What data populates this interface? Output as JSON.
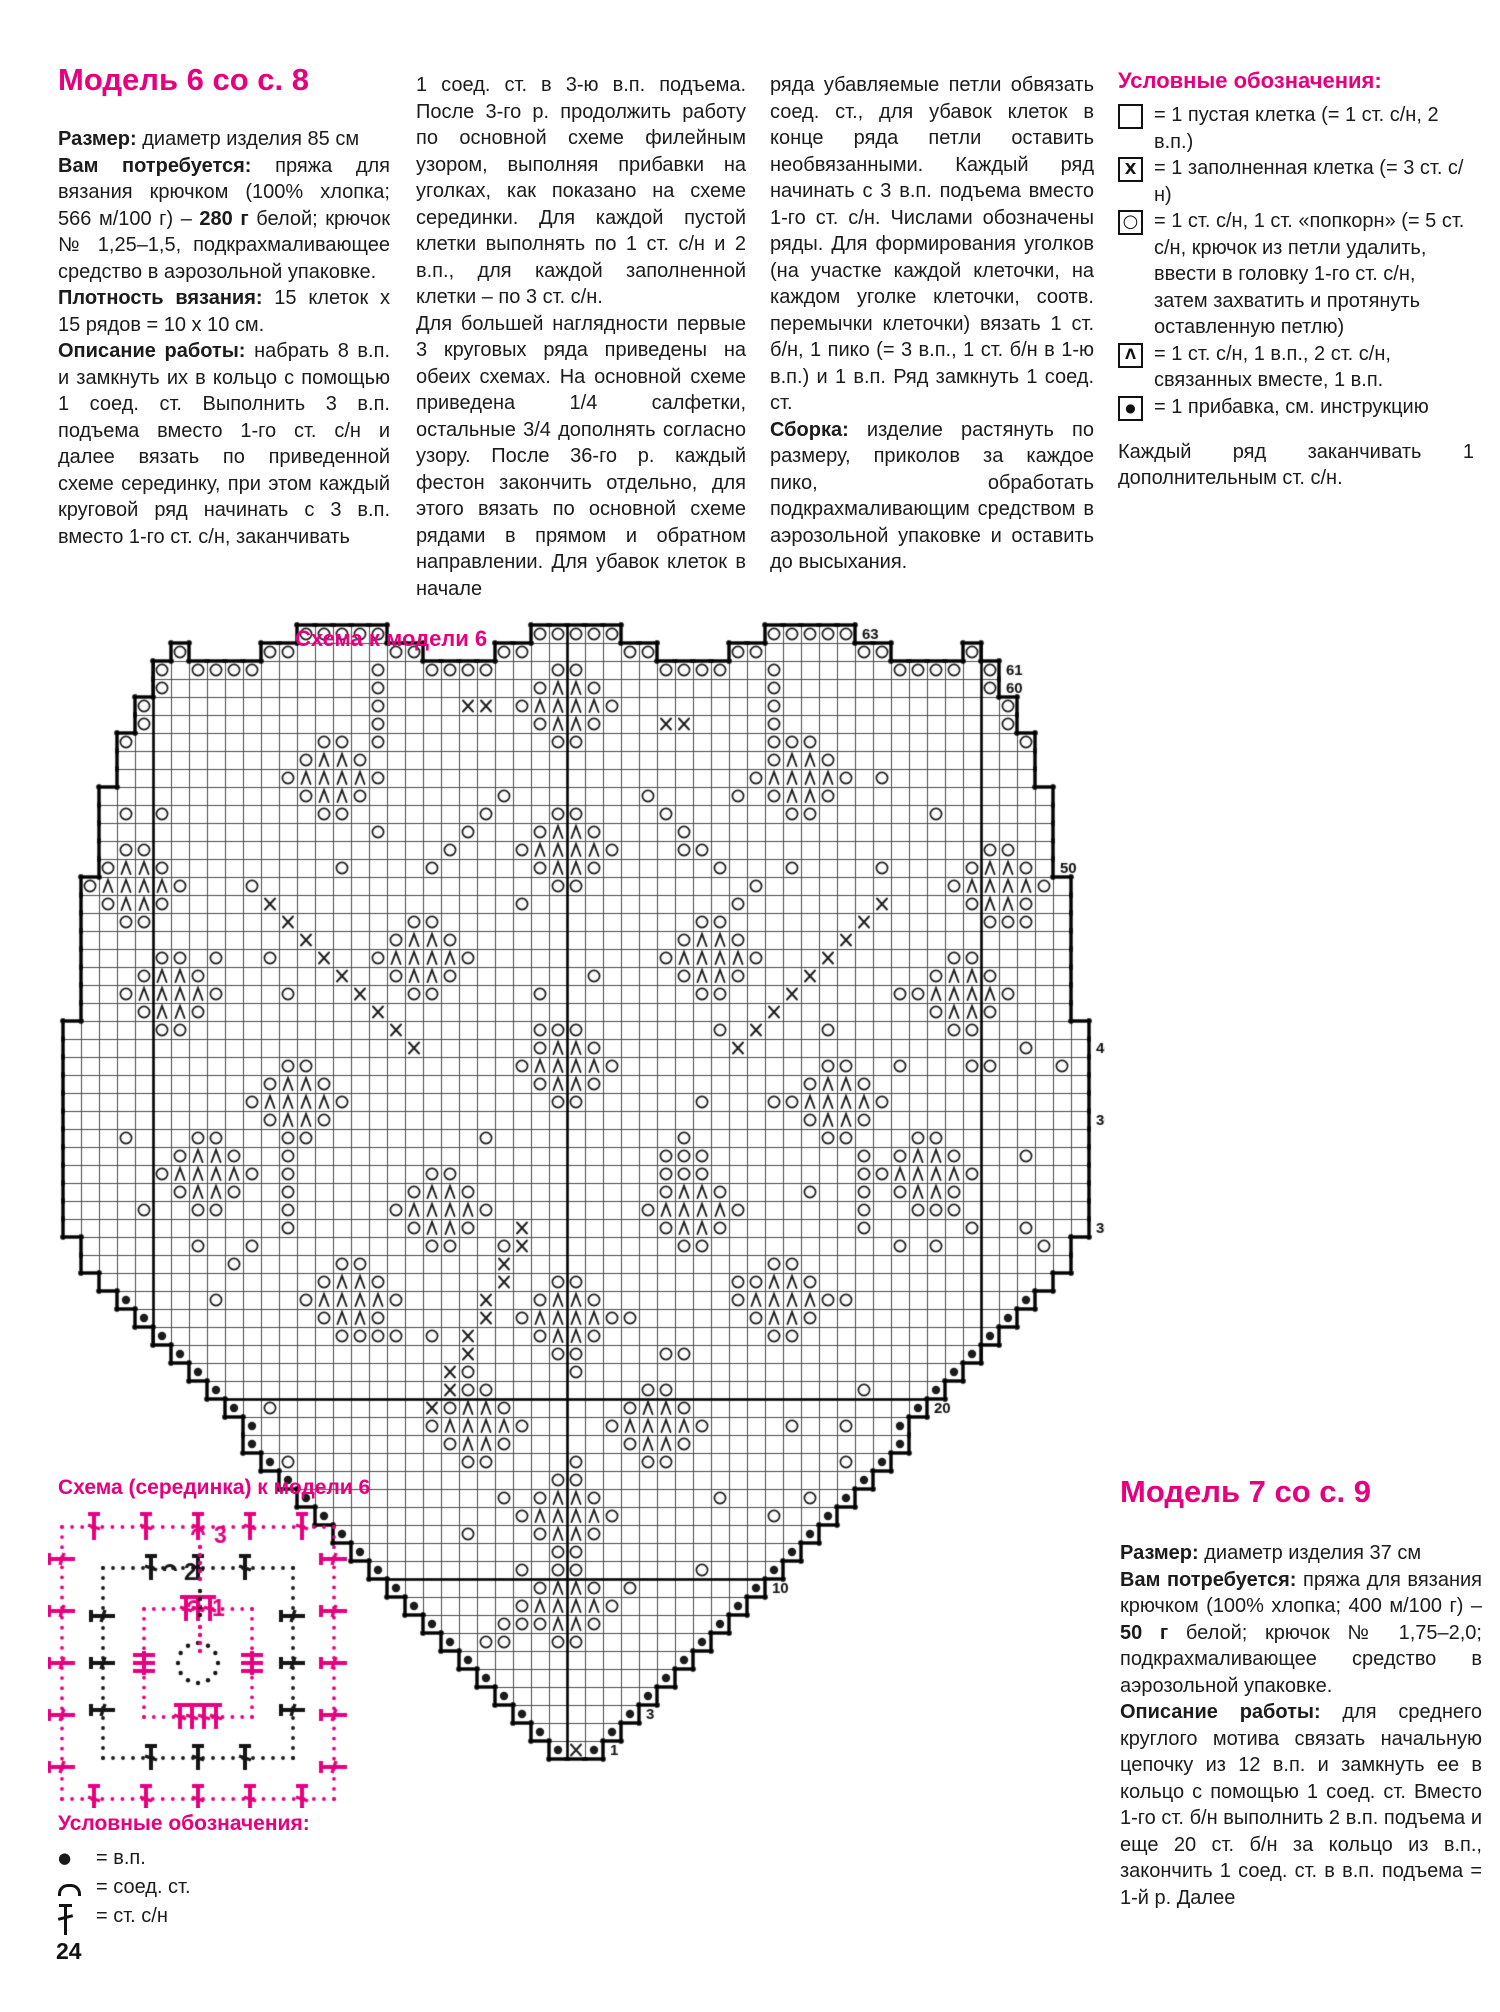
{
  "colors": {
    "accent": "#e6007e",
    "ink": "#1b1b1b",
    "grid": "#4a4a4a"
  },
  "page": {
    "number": "24"
  },
  "model6": {
    "title": "Модель 6 со с. 8",
    "col1": [
      [
        {
          "t": "Размер:",
          "b": true
        },
        {
          "t": " диаметр изделия 85 см"
        }
      ],
      [
        {
          "t": "Вам потребуется:",
          "b": true
        },
        {
          "t": " пряжа для вязания крючком (100% хлопка; 566 м/100 г) – "
        },
        {
          "t": "280 г",
          "b": true
        },
        {
          "t": " белой; крючок № 1,25–1,5, подкрахмаливающее средство в аэрозольной упаковке."
        }
      ],
      [
        {
          "t": "Плотность вязания:",
          "b": true
        },
        {
          "t": " 15 клеток x 15 рядов = 10 x 10 см."
        }
      ],
      [
        {
          "t": "Описание работы:",
          "b": true
        },
        {
          "t": " набрать 8 в.п. и замкнуть их в кольцо с помощью 1 соед. ст. Выполнить 3 в.п. подъема вместо 1-го ст. с/н и далее вязать по приведенной схеме серединку, при этом каждый круговой ряд начинать с 3 в.п. вместо 1-го ст. с/н, заканчивать"
        }
      ]
    ],
    "col2": [
      [
        {
          "t": "1 соед. ст. в 3-ю в.п. подъема. После 3-го р. продолжить работу по основной схеме филейным узором, выполняя прибавки на уголках, как показано на схеме серединки. Для каждой пустой клетки выполнять по 1 ст. с/н и 2 в.п., для каждой заполненной клетки – по 3 ст. с/н."
        }
      ],
      [
        {
          "t": "Для большей наглядности первые 3 круговых ряда приведены на обеих схемах. На основной схеме приведена 1/4 салфетки, остальные 3/4 дополнять согласно узору. После 36-го р. каждый фестон закончить отдельно, для этого вязать по основной схеме рядами в прямом и обратном направлении. Для убавок клеток в начале"
        }
      ]
    ],
    "col3": [
      [
        {
          "t": "ряда убавляемые петли обвязать соед. ст., для убавок клеток в конце ряда петли оставить необвязанными. Каждый ряд начинать с 3 в.п. подъема вместо 1-го ст. с/н. Числами обозначены ряды. Для формирования уголков (на участке каждой клеточки, на каждом уголке клеточки, соотв. перемычки клеточки) вязать 1 ст. б/н, 1 пико (= 3 в.п., 1 ст. б/н в 1-ю в.п.) и 1 в.п. Ряд замкнуть 1 соед. ст."
        }
      ],
      [
        {
          "t": "Сборка:",
          "b": true
        },
        {
          "t": " изделие растянуть по размеру, приколов за каждое пико, обработать подкрахмаливающим средством в аэрозольной упаковке и оставить до высыхания."
        }
      ]
    ]
  },
  "legend": {
    "title": "Условные обозначения:",
    "items": [
      {
        "glyph": "empty",
        "text": "= 1 пустая клетка (= 1 ст. с/н, 2 в.п.)"
      },
      {
        "glyph": "x",
        "text": "= 1 заполненная клетка (= 3 ст. с/н)"
      },
      {
        "glyph": "o",
        "text": "= 1 ст. с/н, 1 ст. «попкорн» (= 5 ст. с/н, крючок из петли удалить, ввести в головку 1-го ст. с/н, затем захватить и протянуть оставленную петлю)"
      },
      {
        "glyph": "lambda",
        "text": "= 1 ст. с/н, 1 в.п., 2 ст. с/н, связанных вместе, 1 в.п."
      },
      {
        "glyph": "dot",
        "text": "= 1 прибавка, см. инструкцию"
      }
    ],
    "note": [
      [
        {
          "t": "Каждый ряд заканчивать 1 дополнительным ст. с/н."
        }
      ]
    ]
  },
  "main_chart": {
    "title": "Схема к модели 6",
    "row_labels": [
      63,
      61,
      60,
      50,
      40,
      36,
      30,
      20,
      10,
      3,
      1
    ],
    "cell_symbols": [
      "O",
      "X",
      "Λ",
      "●"
    ]
  },
  "center_chart": {
    "title": "Схема (серединка) к модели 6",
    "round_labels": [
      "1",
      "2",
      "3"
    ]
  },
  "small_legend": {
    "title": "Условные обозначения:",
    "items": [
      {
        "glyph": "chain",
        "text": "= в.п."
      },
      {
        "glyph": "slip",
        "text": "= соед. ст."
      },
      {
        "glyph": "dc",
        "text": "= ст. с/н"
      }
    ]
  },
  "model7": {
    "title": "Модель 7 со с. 9",
    "paragraphs": [
      [
        {
          "t": "Размер:",
          "b": true
        },
        {
          "t": " диаметр изделия 37 см"
        }
      ],
      [
        {
          "t": "Вам потребуется:",
          "b": true
        },
        {
          "t": " пряжа для вязания крючком (100% хлопка; 400 м/100 г) – "
        },
        {
          "t": "50 г",
          "b": true
        },
        {
          "t": " белой; крючок № 1,75–2,0; подкрахмаливающее средство в аэрозольной упаковке."
        }
      ],
      [
        {
          "t": "Описание работы:",
          "b": true
        },
        {
          "t": " для среднего круглого мотива связать начальную цепочку из 12 в.п. и замкнуть ее в кольцо с помощью 1 соед. ст. Вместо 1-го ст. б/н выполнить 2 в.п. подъема и еще 20 ст. б/н за кольцо из в.п., закончить 1 соед. ст. в в.п. подъема = 1-й р. Далее"
        }
      ]
    ]
  }
}
